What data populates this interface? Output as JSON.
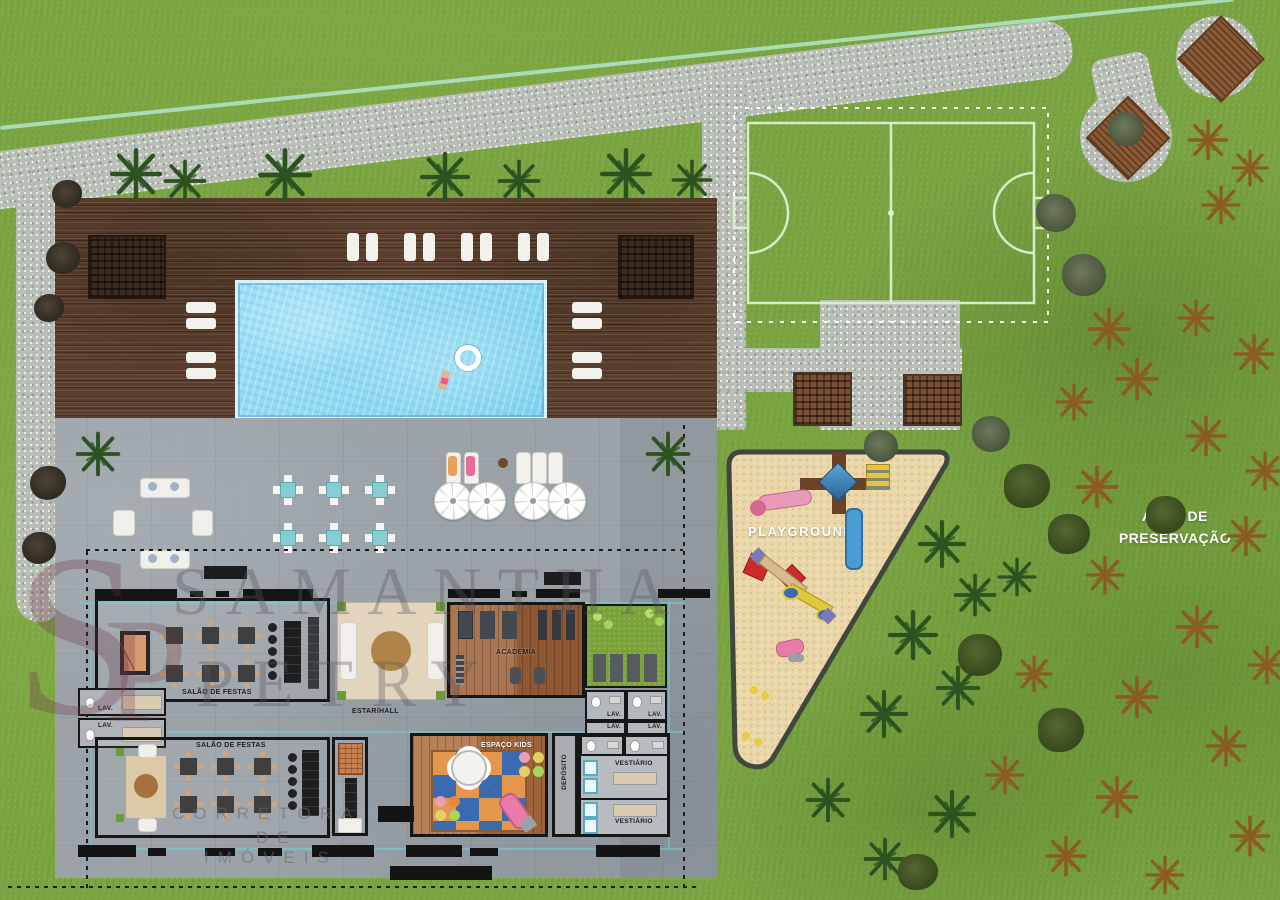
{
  "watermark": {
    "monogram_s": "S",
    "monogram_p": "P",
    "name_line1": "SAMANTHA",
    "name_line2": "PETRY",
    "tagline_line1": "CORRETORA",
    "tagline_line2": "DE",
    "tagline_line3": "IMÓVEIS"
  },
  "site": {
    "playground_label": "PLAYGROUND",
    "preservation_line1": "ÁREA DE",
    "preservation_line2": "PRESERVAÇÃO"
  },
  "floor_plan": {
    "party_hall_upper_label": "SALÃO DE FESTAS",
    "party_hall_lower_label": "SALÃO DE FESTAS",
    "hall_label": "ESTAR/HALL",
    "gym_label": "ACADEMIA",
    "kids_room_label": "ESPAÇO KIDS",
    "storage_label": "DEPÓSITO",
    "locker_upper_label": "VESTIÁRIO",
    "locker_lower_label": "VESTIÁRIO",
    "lav_left_upper": "LAV.",
    "lav_left_lower": "LAV.",
    "lav_grid_1": "LAV.",
    "lav_grid_2": "LAV.",
    "lav_grid_3": "LAV.",
    "lav_grid_4": "LAV."
  },
  "colors": {
    "grass": "#7ba543",
    "gravel": "#b9beb7",
    "deck_wood": "#5b3e2c",
    "pool_water": "#8fd8f1",
    "plaza_paving": "#9ba3a9",
    "sand": "#ead7a9",
    "field_line": "#d9f2d2",
    "wall": "#161616",
    "watermark": "#6e3442"
  }
}
